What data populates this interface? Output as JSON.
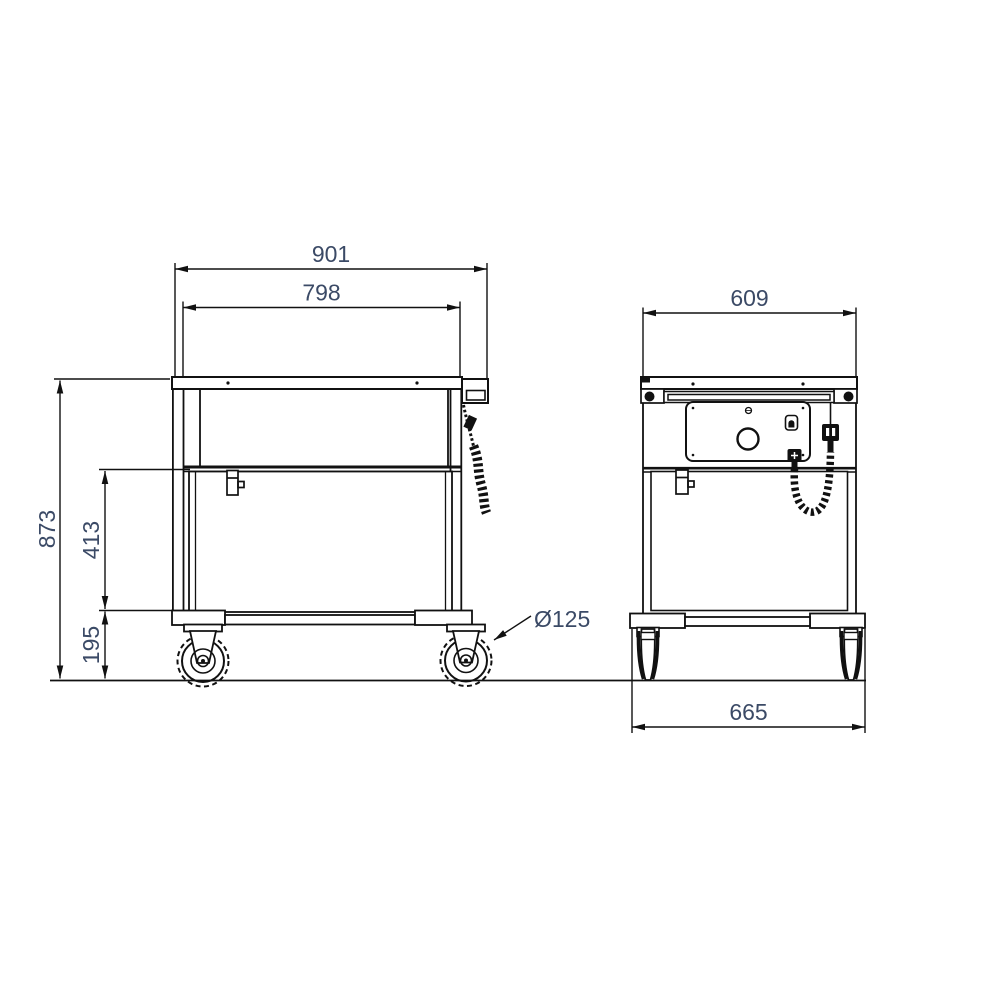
{
  "drawing": {
    "colors": {
      "line_color": "#111111",
      "dimension_text_color": "#3b4a66",
      "background": "#ffffff"
    },
    "side_view": {
      "dimensions": {
        "overall_length": "901",
        "body_length": "798",
        "overall_height": "873",
        "body_height": "413",
        "undercarriage_height": "195",
        "caster_diameter": "Ø125"
      }
    },
    "front_view": {
      "dimensions": {
        "top_depth": "609",
        "base_depth": "665"
      }
    }
  }
}
